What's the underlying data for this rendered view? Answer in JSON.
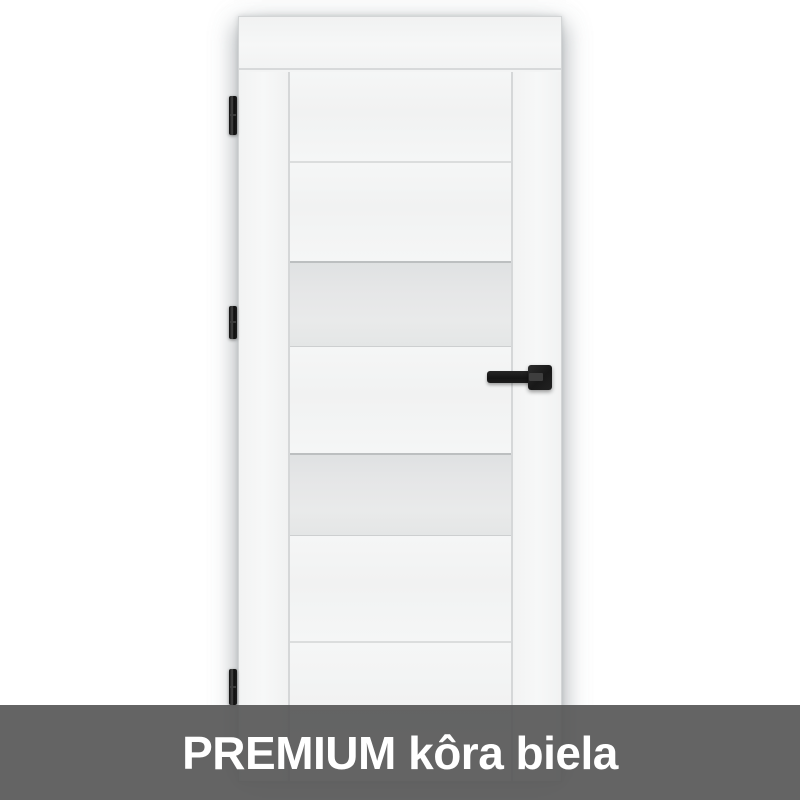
{
  "banner": {
    "label": "PREMIUM kôra biela",
    "background": "#656565",
    "text_color": "#ffffff"
  },
  "product_image": {
    "subject": "white interior door, front view",
    "door_color": "#f3f4f4",
    "glass_color": "#e4e6e6",
    "hardware_color": "#1b1b1b",
    "glass_panels": 2,
    "hinges": 3,
    "handle": "black square-rosette lever handle on right side",
    "hinge_side": "left"
  }
}
